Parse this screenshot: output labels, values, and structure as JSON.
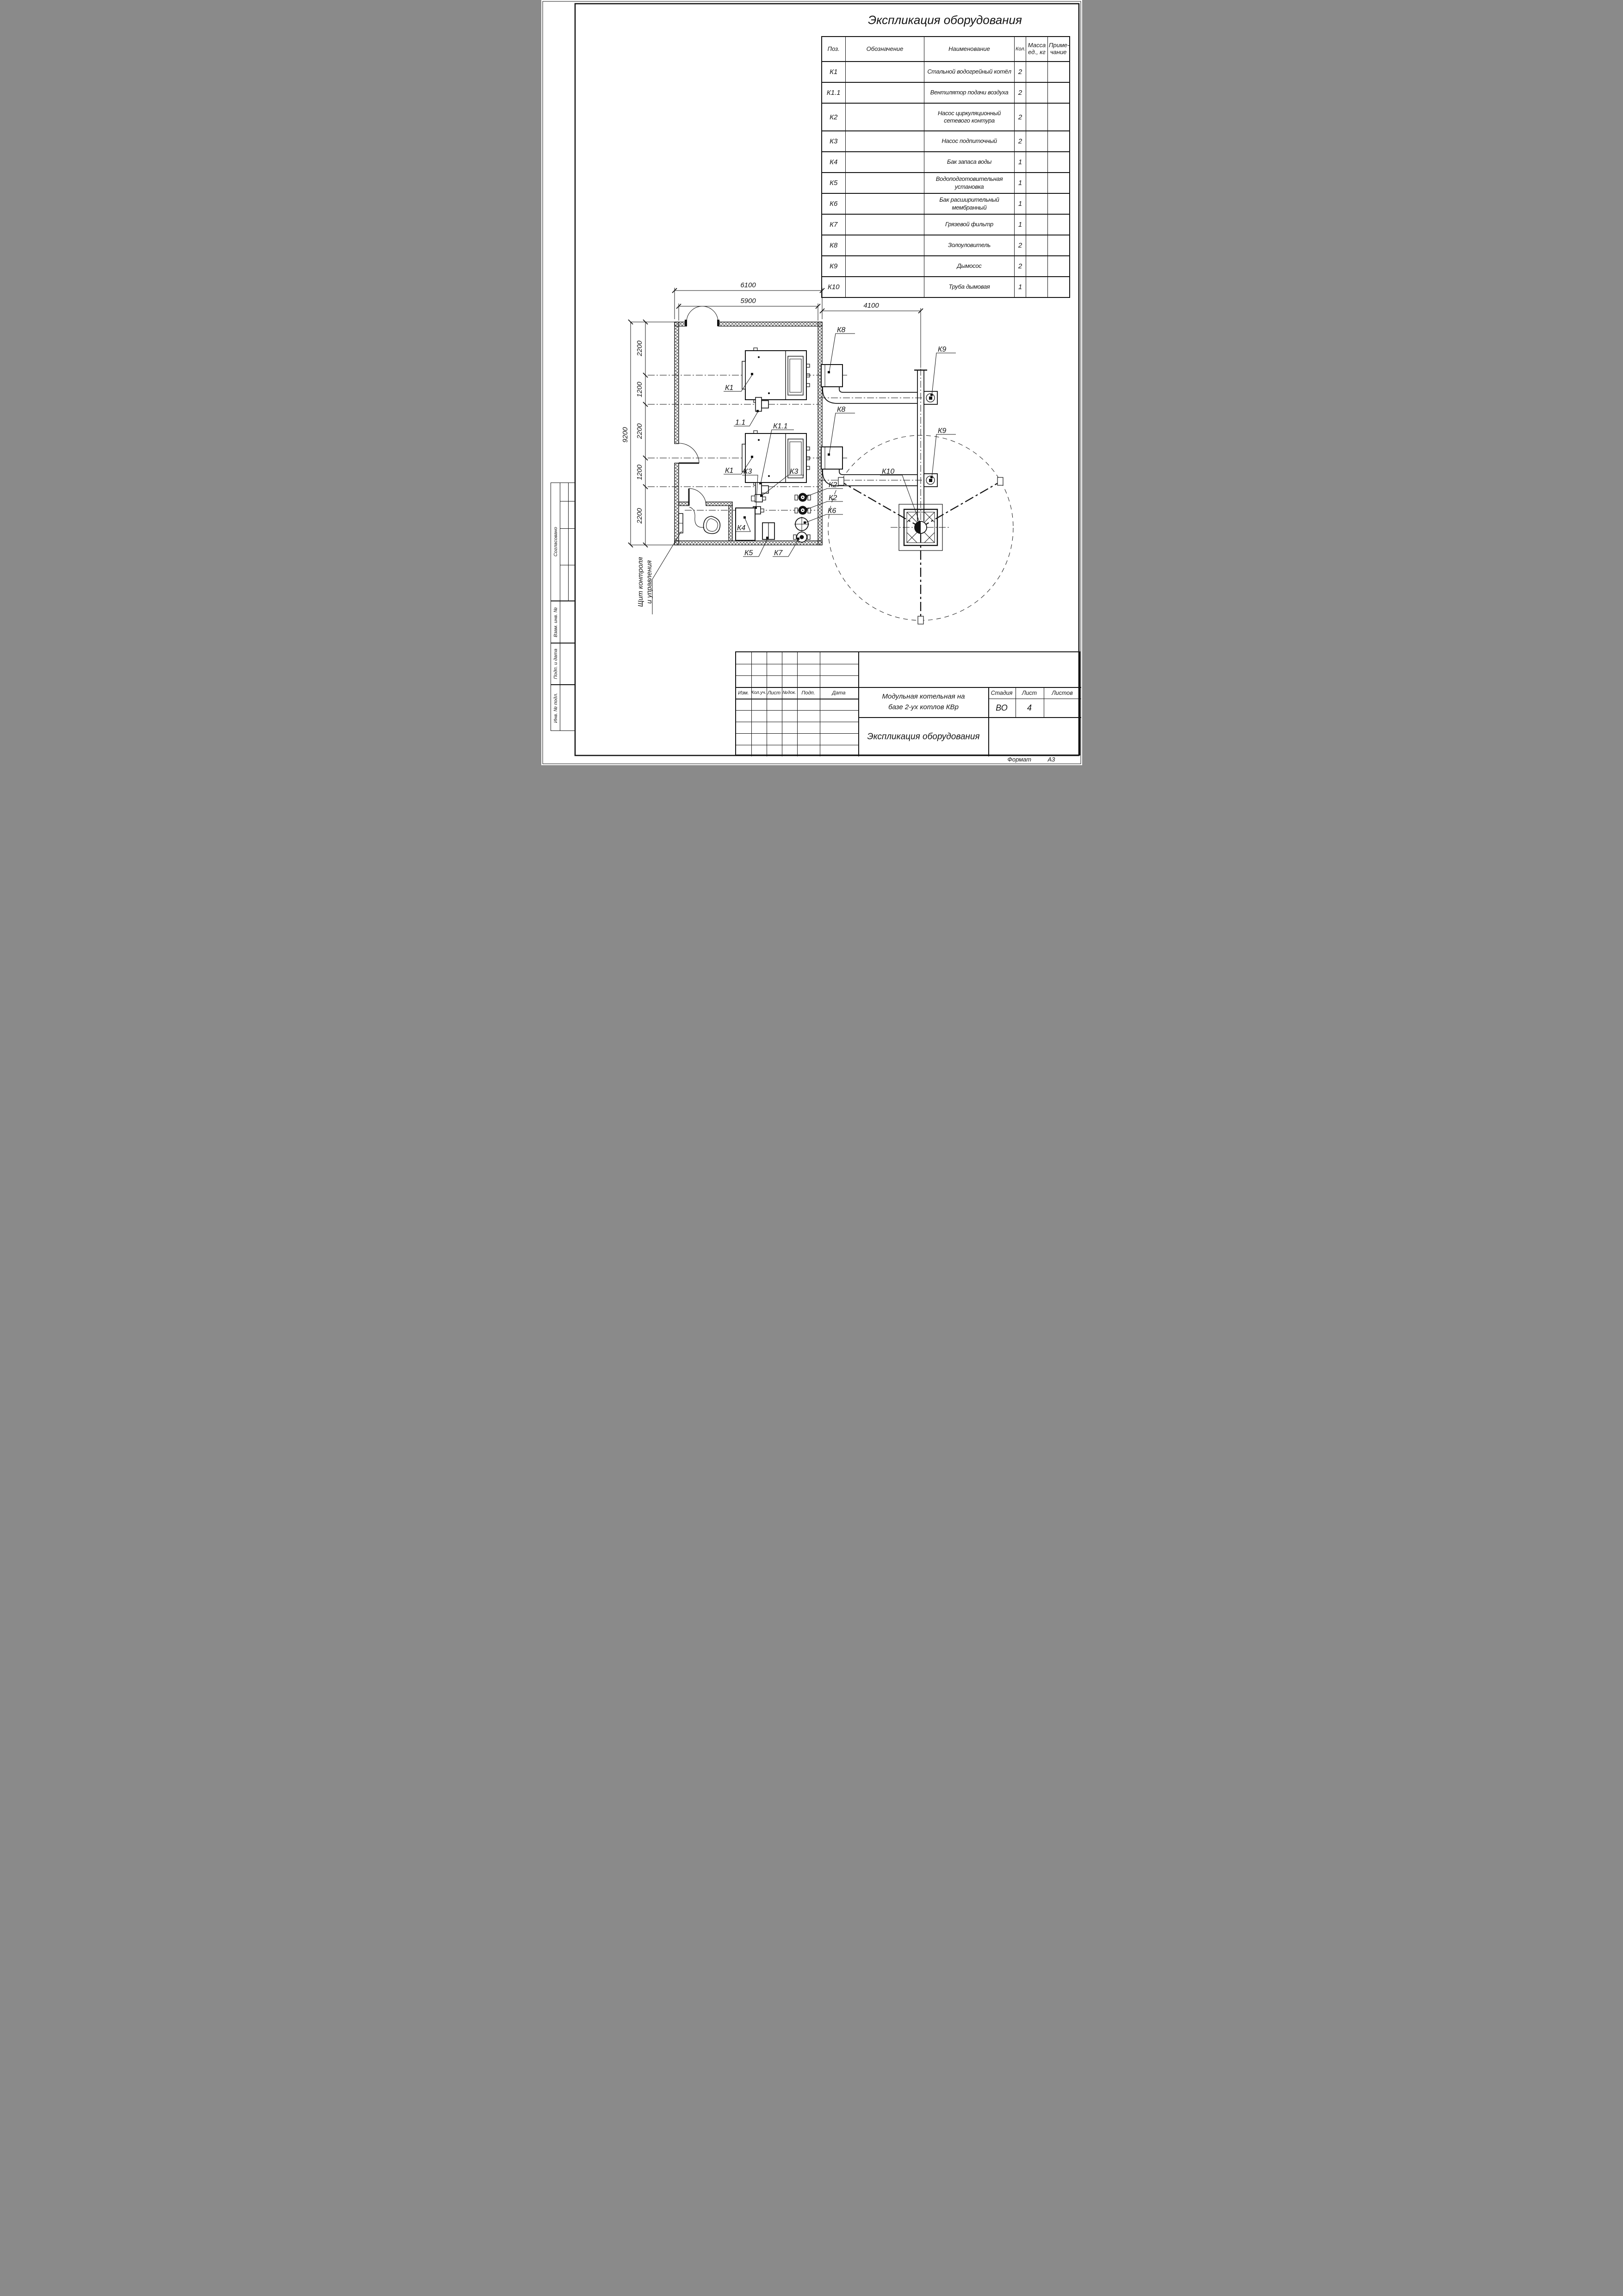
{
  "page": {
    "format_label": "Формат",
    "format_value": "А3"
  },
  "spec_table": {
    "title": "Экспликация оборудования",
    "headers": {
      "pos": "Поз.",
      "designation": "Обозначение",
      "name": "Наименование",
      "qty": "Кол.",
      "mass": "Масса\nед., кг",
      "note": "Приме-\nчание"
    },
    "rows": [
      {
        "pos": "К1",
        "name": "Стальной водогрейный котёл",
        "qty": "2"
      },
      {
        "pos": "К1.1",
        "name": "Вентилятор подачи воздуха",
        "qty": "2"
      },
      {
        "pos": "К2",
        "name": "Насос циркуляционный\nсетевого контура",
        "qty": "2"
      },
      {
        "pos": "К3",
        "name": "Насос подпиточный",
        "qty": "2"
      },
      {
        "pos": "К4",
        "name": "Бак запаса воды",
        "qty": "1"
      },
      {
        "pos": "К5",
        "name": "Водоподготовительная установка",
        "qty": "1"
      },
      {
        "pos": "К6",
        "name": "Бак расширительный мембранный",
        "qty": "1"
      },
      {
        "pos": "К7",
        "name": "Грязевой фильтр",
        "qty": "1"
      },
      {
        "pos": "К8",
        "name": "Золоуловитель",
        "qty": "2"
      },
      {
        "pos": "К9",
        "name": "Дымосос",
        "qty": "2"
      },
      {
        "pos": "К10",
        "name": "Труба дымовая",
        "qty": "1"
      }
    ]
  },
  "plan": {
    "dims": {
      "overall_width": "6100",
      "inner_width": "5900",
      "flue_offset": "4100",
      "overall_height": "9200",
      "chain": [
        "2200",
        "1200",
        "2200",
        "1200",
        "2200"
      ]
    },
    "labels": {
      "k1": "К1",
      "k1_fan": "1.1",
      "k1_1": "К1.1",
      "k2": "К2",
      "k3": "К3",
      "k4": "К4",
      "k5": "К5",
      "k6": "К6",
      "k7": "К7",
      "k8": "К8",
      "k9": "К9",
      "k10": "К10"
    },
    "callout_control_panel": "Щит контроля\nи управления"
  },
  "title_block": {
    "rev_cols": [
      "Изм.",
      "Кол.уч.",
      "Лист",
      "№док.",
      "Подп.",
      "Дата"
    ],
    "project": "Модульная котельная на\nбазе 2-ух котлов КВр",
    "sheet_name": "Экспликация оборудования",
    "stage_label": "Стадия",
    "sheet_label": "Лист",
    "sheets_label": "Листов",
    "stage": "ВО",
    "sheet": "4",
    "sheets": ""
  },
  "side_stamps": {
    "agreed": "Согласовано",
    "repl_inv": "Взам. инв. №",
    "sign_date": "Подп. и дата",
    "inv_orig": "Инв. № подл."
  }
}
